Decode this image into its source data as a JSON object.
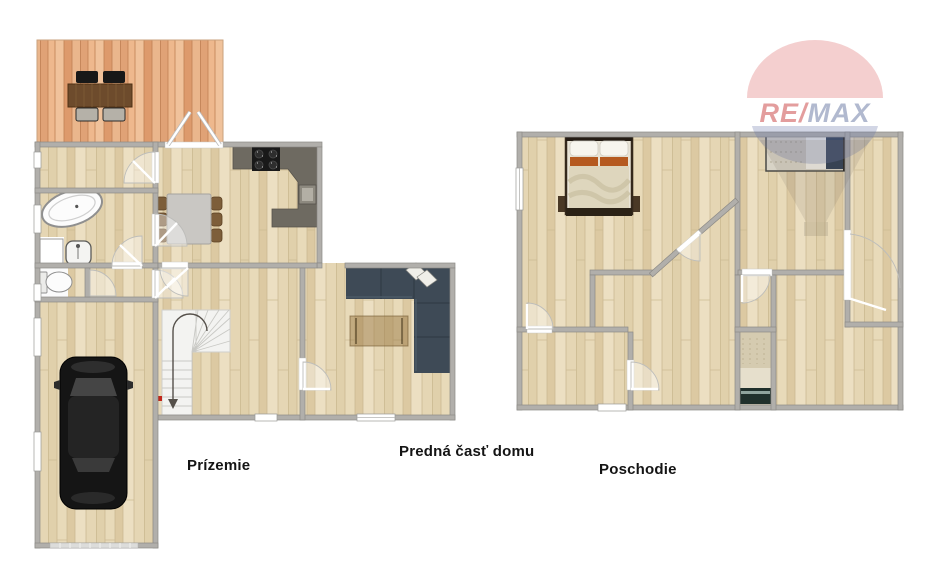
{
  "labels": {
    "ground_floor": "Prízemie",
    "front_part": "Predná časť domu",
    "upper_floor": "Poschodie"
  },
  "watermark": {
    "brand_re": "RE/",
    "brand_max": "MAX"
  },
  "colors": {
    "wall": "#b1afab",
    "floor_wood_base": "#e5d6b4",
    "deck_wood_base": "#eab68c",
    "kitchen_counter": "#6e6a61",
    "cooktop": "#191919",
    "sofa": "#3e4a56",
    "coffee_table": "#9b7b48",
    "car_body": "#151515",
    "deck_table": "#6d4b2c",
    "dining_table": "#c9c7c3",
    "dining_chair": "#7d5e3a",
    "bed_orange": "#b55a20",
    "bed_pillow_navy": "#2c3b50",
    "stairs": "#f3f3f1",
    "arrow_red": "#c1271b",
    "label_text": "#141414",
    "logo_red": "#c84b4b",
    "logo_blue": "#6f7fae"
  }
}
